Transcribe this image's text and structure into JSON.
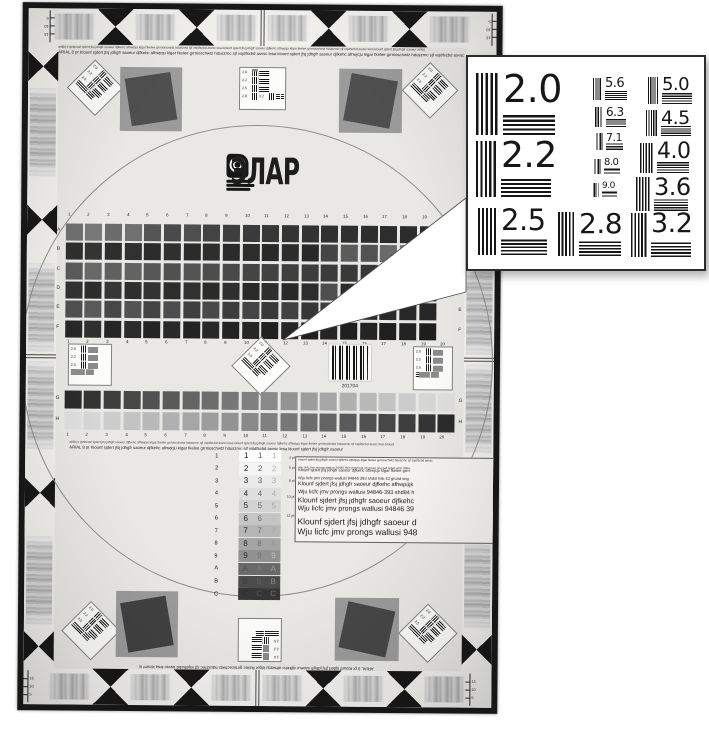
{
  "page": {
    "background": "#ffffff"
  },
  "chart": {
    "frame_color": "#171717",
    "surface_color": "#e9e8e5",
    "circle_color": "#8e8e8e",
    "header_microtext_line1": "whlbj s jprtkcuvl sjdert jfsj jdhgfr saoeur djfkehc afhwjcju klgar fkelee grrnioschwtz hduszrnc sjf vsjdfscbd asvsc lesa klounf sjdert jfsj jdhgfr saoeur djfkehc afhwjcju klgar fkelee grrnioschwtz hduszrnc sjf vsjdfscbd asvsc lesa klounf sjdert jfsj jdhgfr saoeur whlbj",
    "header_microtext_line2": "ARIAL 8 pt Klounf sjdert jfsj jdhgfr saoeur djfkehc afhwjcju klgar fkelee grrnioschwtz hduszrnc sjf vsjdfscbd asvsc lesa klounf sjdert jfsj jdhgfr saoeur djfkehc afhwjcju klgar fkelee grrnioschwtz hduszrnc sjf vsjdfscbd asvsc lesa klounf sjdert jfsj jdhgfr saoeurd",
    "mid_microtext_line1": "whlbj s jprtkcuvl sjdert jfsj jdhgfr saoeur djfkehc afhwjcju klgar fkelee grrnioschwtz hduszrnc sjf vsjdfscbd asvsc lesa klounf sjdert jfsj jdhgfr saoeur djfkehc afhwjcju klgar fkelee grrnioschwtz hduszrnc sjf vsjdfscbd asvsc lesa klounf",
    "mid_microtext_line2": "ARIAL 8 pt Klounf sjdert jfsj jdhgfr saoeur djfkehc afhwjcju klgar fkelee grrnioschwtz hduszrnc sjf vsjdfscbd asvsc lesa klounf sjdert jfsj jdhgfr saoeur",
    "footer_microtext": "ARIAL 8 pt Klounf sjdert jfsj jdhgfr saoeur djfkehc afhwjcju klgar fkelee grrnioschwtz hduszrnc sjf vsjdfscbd asvsc lesa klounf sjdert jfsj jdhgfr saoeur djfkehc afhwjcju klgar fkelee grrnioschwtz hduszrnc",
    "logo_text": "ЭЛАР",
    "logo_icon": "disc-scanner-icon",
    "ruler_numbers": [
      "5",
      "10",
      "15"
    ],
    "mini_target_labels": [
      "2.0",
      "2.2",
      "2.5"
    ],
    "center_target_labels": [
      "2.0",
      "2.2",
      "2.5",
      "2.8",
      "3.2"
    ],
    "barcode": {
      "number": "201704"
    },
    "grid": {
      "top_numbers": [
        "1",
        "2",
        "3",
        "4",
        "5",
        "6",
        "7",
        "8",
        "9",
        "10",
        "11",
        "12",
        "13",
        "14",
        "15",
        "16",
        "17",
        "18",
        "19"
      ],
      "bottom_numbers": [
        "1",
        "2",
        "3",
        "4",
        "5",
        "6",
        "7",
        "8",
        "9",
        "10",
        "11",
        "12",
        "13",
        "14",
        "15",
        "16",
        "17",
        "18",
        "19",
        "20"
      ],
      "left_letters": [
        "A",
        "B",
        "C",
        "D",
        "E",
        "F"
      ],
      "right_letters": [
        "A",
        "B",
        "C",
        "D",
        "E",
        "F"
      ],
      "rows": [
        [
          "#707070",
          "#787878",
          "#6b6b6b",
          "#717171",
          "#555555",
          "#4a4a4a",
          "#4e4e4e",
          "#434343",
          "#3e3e3e",
          "#3a3a3a",
          "#373737",
          "#343434",
          "#323232",
          "#303030",
          "#2f2f2f",
          "#2e2e2e",
          "#2d2d2d",
          "#2c2c2c",
          "#2b2b2b"
        ],
        [
          "#2f2f2f",
          "#343434",
          "#2d2d2d",
          "#313131",
          "#2c2c2c",
          "#303030",
          "#2b2b2b",
          "#2e2e2e",
          "#2a2a2a",
          "#2d2d2d",
          "#292929",
          "#2c2c2c",
          "#282828",
          "#454545",
          "#5b5b5b",
          "#525252",
          "#6a6a6a",
          "#7a7a7a",
          "#565656"
        ],
        [
          "#5a5a5a",
          "#686868",
          "#606060",
          "#636363",
          "#575757",
          "#515151",
          "#545454",
          "#4d4d4d",
          "#494949",
          "#454545",
          "#424242",
          "#3f3f3f",
          "#3d3d3d",
          "#3b3b3b",
          "#393939",
          "#373737",
          "#363636",
          "#353535",
          "#343434"
        ],
        [
          "#313131",
          "#2c2c2c",
          "#363636",
          "#2f2f2f",
          "#333333",
          "#2d2d2d",
          "#313131",
          "#2b2b2b",
          "#2f2f2f",
          "#2a2a2a",
          "#2e2e2e",
          "#292929",
          "#2d2d2d",
          "#4e4e4e",
          "#2c2c2c",
          "#282828",
          "#2b2b2b",
          "#272727",
          "#2a2a2a"
        ],
        [
          "#4f4f4f",
          "#595959",
          "#474747",
          "#535353",
          "#434343",
          "#4d4d4d",
          "#3f3f3f",
          "#494949",
          "#3c3c3c",
          "#454545",
          "#393939",
          "#414141",
          "#373737",
          "#3d3d3d",
          "#353535",
          "#2b2b2b",
          "#292929",
          "#282828",
          "#272727"
        ],
        [
          "#272727",
          "#2f2f2f",
          "#252525",
          "#2b2b2b",
          "#242424",
          "#292929",
          "#232323",
          "#282828",
          "#222222",
          "#272727",
          "#212121",
          "#262626",
          "#202020",
          "#252525",
          "#1f1f1f",
          "#242424",
          "#1f1f1f",
          "#232323",
          "#1e1e1e"
        ]
      ]
    },
    "wedges": {
      "letters": [
        "G",
        "H"
      ],
      "numbers": [
        "1",
        "2",
        "3",
        "4",
        "5",
        "6",
        "7",
        "8",
        "9",
        "10",
        "11",
        "12",
        "13",
        "14",
        "15",
        "16",
        "17",
        "18",
        "19",
        "20"
      ],
      "g_colors": [
        "#2b2b2b",
        "#343434",
        "#3e3e3e",
        "#474747",
        "#515151",
        "#5a5a5a",
        "#646464",
        "#6d6d6d",
        "#777777",
        "#808080",
        "#8a8a8a",
        "#939393",
        "#9d9d9d",
        "#a6a6a6",
        "#b0b0b0",
        "#b9b9b9",
        "#c3c3c3",
        "#cccccc",
        "#d6d6d6",
        "#dfdfdf"
      ],
      "h_colors": [
        "#dfdfdf",
        "#d6d6d6",
        "#cccccc",
        "#c3c3c3",
        "#b9b9b9",
        "#b0b0b0",
        "#a6a6a6",
        "#9d9d9d",
        "#939393",
        "#8a8a8a",
        "#808080",
        "#777777",
        "#6d6d6d",
        "#646464",
        "#5a5a5a",
        "#515151",
        "#474747",
        "#3e3e3e",
        "#343434",
        "#2b2b2b"
      ]
    },
    "contrast_block": {
      "rows": [
        {
          "label": "1",
          "bg": "#fcfcfc",
          "inks": [
            "#161616",
            "#5f5f5f",
            "#b5b5b5"
          ]
        },
        {
          "label": "2",
          "bg": "#f4f4f4",
          "inks": [
            "#171717",
            "#606060",
            "#b2b2b2"
          ]
        },
        {
          "label": "3",
          "bg": "#eaeaea",
          "inks": [
            "#181818",
            "#616161",
            "#b0b0b0"
          ]
        },
        {
          "label": "4",
          "bg": "#dedede",
          "inks": [
            "#191919",
            "#636363",
            "#aeaeae"
          ]
        },
        {
          "label": "5",
          "bg": "#d2d2d2",
          "inks": [
            "#1a1a1a",
            "#656565",
            "#ababab"
          ]
        },
        {
          "label": "6",
          "bg": "#c5c5c5",
          "inks": [
            "#1b1b1b",
            "#676767",
            "#bfbfbf"
          ]
        },
        {
          "label": "7",
          "bg": "#b5b5b5",
          "inks": [
            "#1c1c1c",
            "#696969",
            "#a2a2a2"
          ]
        },
        {
          "label": "8",
          "bg": "#a5a5a5",
          "inks": [
            "#1d1d1d",
            "#6b6b6b",
            "#979797"
          ]
        },
        {
          "label": "9",
          "bg": "#919191",
          "inks": [
            "#2a2a2a",
            "#707070",
            "#c0c0c0"
          ]
        },
        {
          "label": "A",
          "bg": "#696969",
          "inks": [
            "#4f4f4f",
            "#7a7a7a",
            "#9e9e9e"
          ]
        },
        {
          "label": "B",
          "bg": "#4c4c4c",
          "inks": [
            "#3e3e3e",
            "#5c5c5c",
            "#8a8a8a"
          ]
        },
        {
          "label": "C",
          "bg": "#363636",
          "inks": [
            "#2b2b2b",
            "#565656",
            "#757575"
          ]
        }
      ]
    },
    "type_block": {
      "rows": [
        {
          "size": "4 pt",
          "line1": "Klounf sjdert jfsj jdhgfr saoeur djfkehc afhwjcju klgar fkelee grrnioschwtz hduszrnc sjf vsjdfscbd asvsc",
          "line2": "Wju licfc jmv prongs wallusi 94846 393 shdsl hsk 43 grrurc sng swf sjdert wjsn dhfks"
        },
        {
          "size": "6 pt",
          "line1": "Klounf sjdert jfsj jdhgfr saoeur djfkehc afhwjcju klgar fkelee grrn",
          "line2": "Wju licfc jmv prongs wallusi 94846 393 shdsl hsk 43 grund sng"
        },
        {
          "size": "8 pt",
          "line1": "Klounf sjdert jfsj jdhgfr saoeur djfkehc afhwpüjk",
          "line2": "Wju licfc jmv prongs wallusi 94846-393 shd94 h"
        },
        {
          "size": "10 pt",
          "line1": "Klounf sjdert jfsj jdhgfr saoeur djfkehc",
          "line2": "Wju licfc jmv prongs wallusi 94846 39"
        },
        {
          "size": "12 pt",
          "line1": "Klounf sjdert jfsj jdhgfr saoeur d",
          "line2": "Wju licfc jmv prongs wallusi 948"
        }
      ]
    }
  },
  "inset": {
    "border_color": "#2c2c2c",
    "items": [
      {
        "label": "2.0"
      },
      {
        "label": "2.2"
      },
      {
        "label": "2.5"
      },
      {
        "label": "2.8"
      },
      {
        "label": "3.2"
      },
      {
        "label": "3.6"
      },
      {
        "label": "4.0"
      },
      {
        "label": "4.5"
      },
      {
        "label": "5.0"
      },
      {
        "label": "5.6"
      },
      {
        "label": "6.3"
      },
      {
        "label": "7.1"
      },
      {
        "label": "8.0"
      },
      {
        "label": "9.0"
      }
    ]
  }
}
